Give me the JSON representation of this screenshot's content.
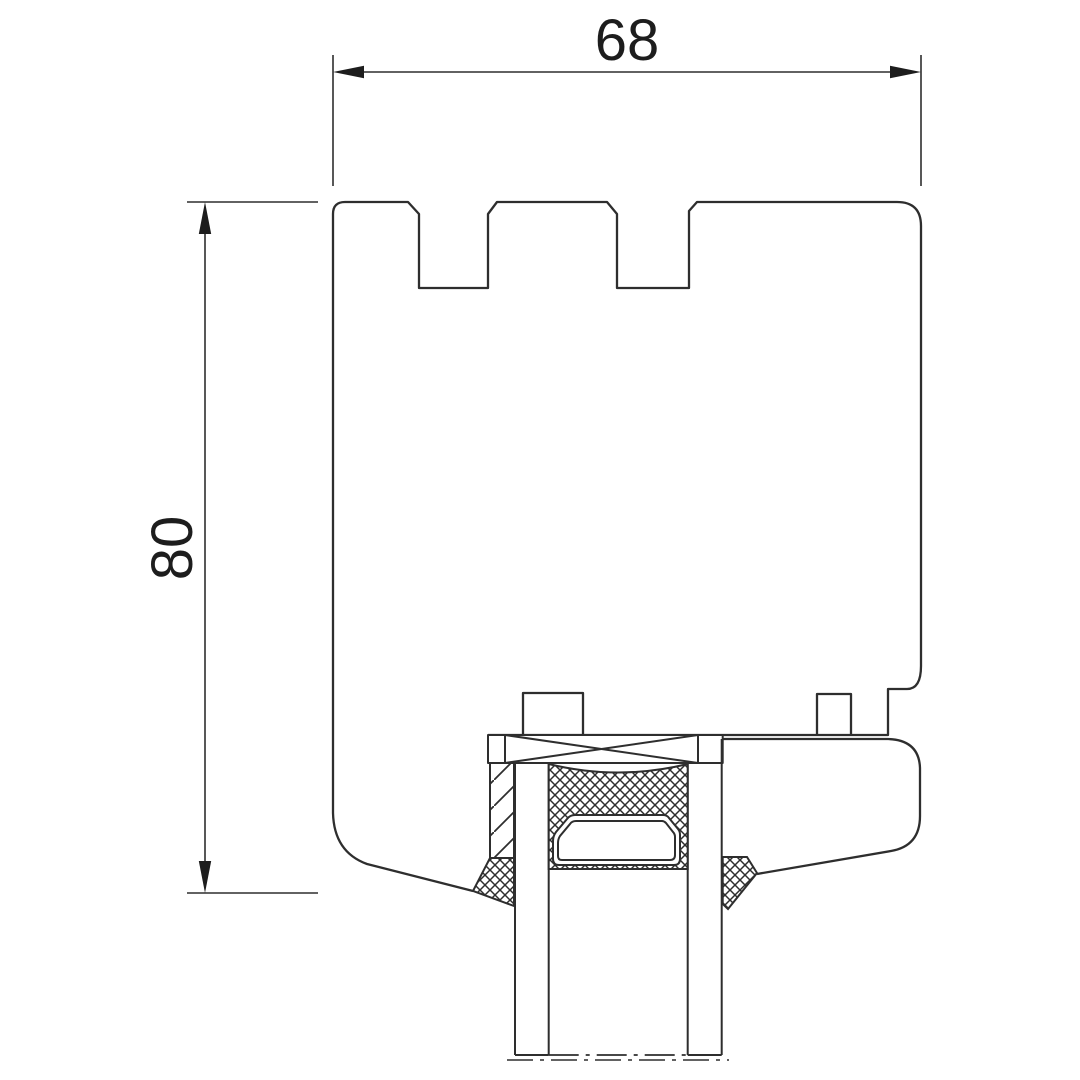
{
  "drawing": {
    "kind": "window-profile-cross-section",
    "background_color": "#ffffff",
    "line_color": "#2e2e2e",
    "dimensions": {
      "width": {
        "value": "68"
      },
      "height": {
        "value": "80"
      }
    }
  }
}
